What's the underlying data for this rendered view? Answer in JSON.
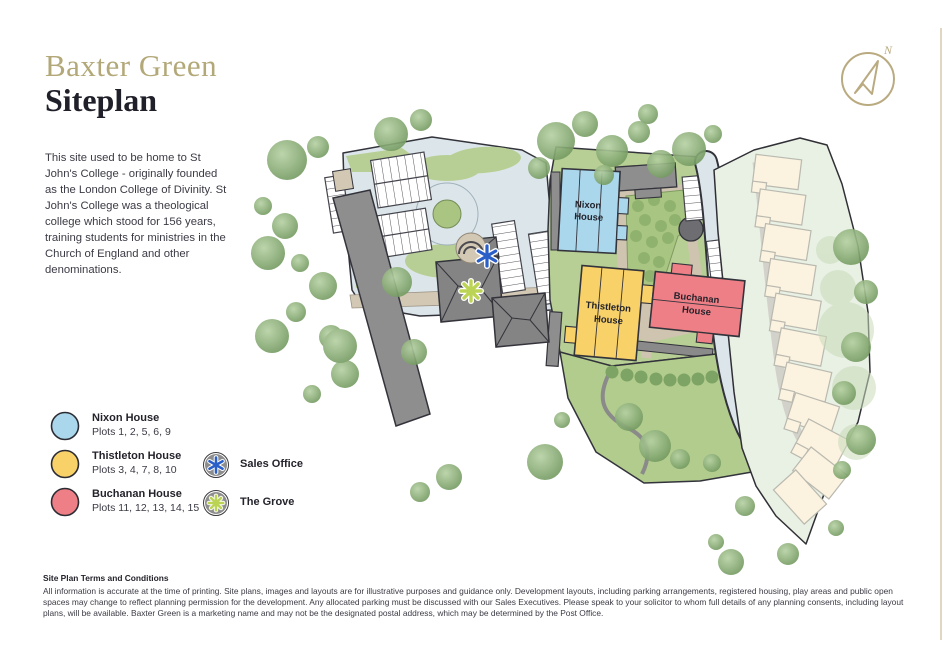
{
  "header": {
    "brand": "Baxter Green",
    "page_title": "Siteplan",
    "intro": "This site used to be home to St John's College - originally founded as the London College of Divinity. St John's College was a theological college which stood for 156 years, training students for ministries in the Church of England and other denominations."
  },
  "compass": {
    "north_label": "N"
  },
  "legend": {
    "houses": [
      {
        "name": "Nixon House",
        "plots": "Plots 1, 2, 5, 6, 9",
        "color": "#abd7ec"
      },
      {
        "name": "Thistleton House",
        "plots": "Plots 3, 4, 7, 8, 10",
        "color": "#f8d168"
      },
      {
        "name": "Buchanan House",
        "plots": "Plots 11, 12, 13, 14, 15",
        "color": "#ef7f86"
      }
    ],
    "markers": [
      {
        "name": "Sales Office",
        "icon": "asterisk-6-spoke",
        "icon_color": "#2a5fc8",
        "disc_color": "#8d8d8d"
      },
      {
        "name": "The Grove",
        "icon": "asterisk-8-spoke",
        "icon_color": "#bcd455",
        "disc_color": "#8d8d8d"
      }
    ]
  },
  "siteplan": {
    "labels": {
      "nixon_1": "Nixon",
      "nixon_2": "House",
      "thistleton_1": "Thistleton",
      "thistleton_2": "House",
      "buchanan_1": "Buchanan",
      "buchanan_2": "House"
    },
    "colors": {
      "road": "#dce6ea",
      "grass": "#b7cf94",
      "path": "#cfc4b0",
      "building_gray": "#8e8e8e",
      "future_parcel": "#e9f0e4",
      "future_house": "#fbf2df",
      "outline": "#33333b",
      "accent_gold": "#b3a878"
    }
  },
  "terms": {
    "heading": "Site Plan Terms and Conditions",
    "body": "All information is accurate at the time of printing. Site plans, images and layouts are for illustrative purposes and guidance only. Development layouts, including parking arrangements, registered housing, play areas and public open spaces may change to reflect planning permission for the development. Any allocated parking must be discussed with our Sales Executives. Please speak to your solicitor to whom full details of any planning consents, including layout plans, will be available. Baxter Green is a marketing name and may not be the designated postal address, which may be determined by the Post Office."
  }
}
